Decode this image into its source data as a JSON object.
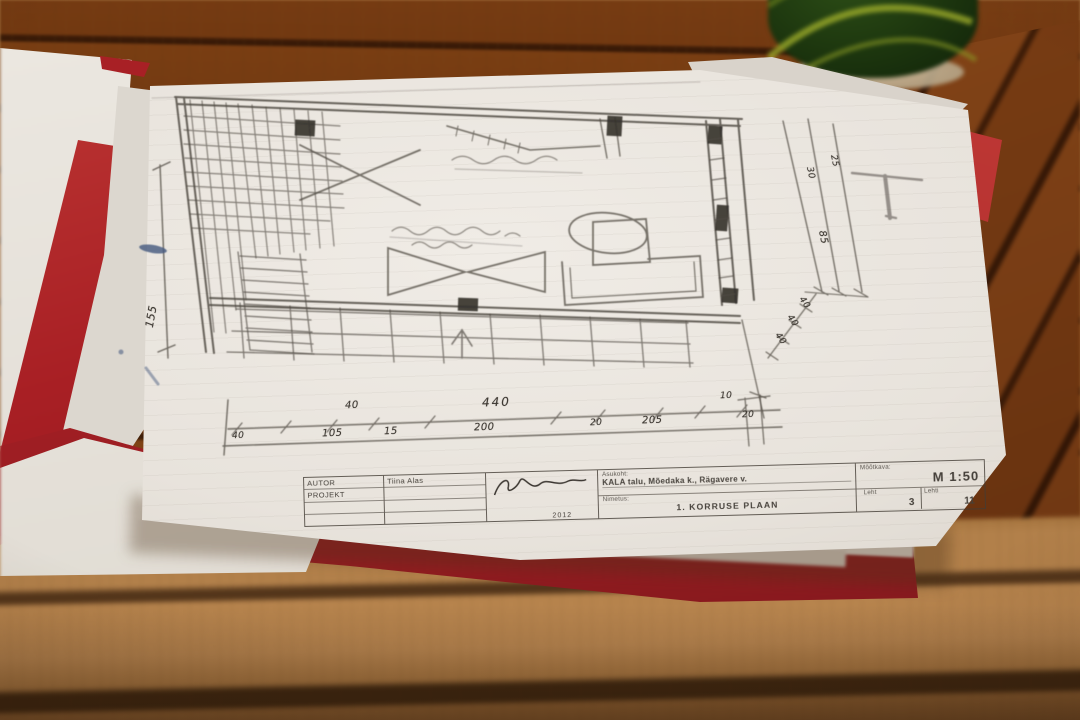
{
  "title_block": {
    "autor_label": "AUTOR",
    "projekt_label": "PROJEKT",
    "author_name": "Tiina Alas",
    "signature_year": "2012",
    "asukoht_label": "Asukoht:",
    "asukoht_value": "KALA talu, Mõedaka k., Rägavere v.",
    "nimetus_label": "Nimetus:",
    "nimetus_value": "1. KORRUSE PLAAN",
    "mootkava_label": "Mõõtkava:",
    "mootkava_value": "M 1:50",
    "leht_label": "Leht",
    "leht_value": "3",
    "lehti_label": "Lehti",
    "lehti_value": "11"
  },
  "dims": {
    "left_vertical": "155",
    "bottom_upper": [
      "40",
      "440",
      "10"
    ],
    "bottom_lower": [
      "40",
      "105",
      "15",
      "200",
      "20",
      "205",
      "20"
    ],
    "right_fan": [
      "25",
      "30",
      "85",
      "40",
      "40",
      "40"
    ]
  },
  "colors": {
    "wood": "#b0804a",
    "wood_gap": "#53351a",
    "folder_red": "#a82025",
    "paper": "#e9e5df",
    "pencil": "#4f4a42",
    "pen_blue": "#44597f",
    "cup_green": "#1c350e",
    "cup_streak": "#9aa82c"
  }
}
